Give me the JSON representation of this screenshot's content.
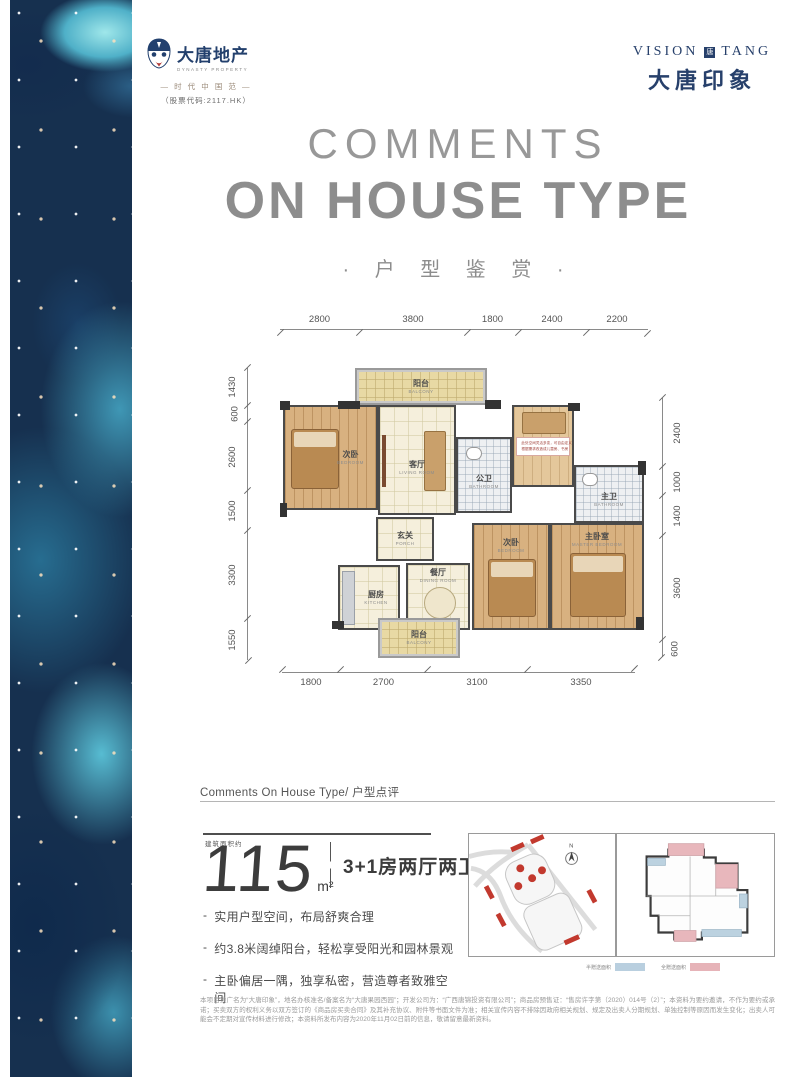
{
  "brand_left": {
    "name_cn": "大唐地产",
    "name_en": "DYNASTY PROPERTY",
    "slogan": "— 时 代 中 国 范 —",
    "stock_code": "（股票代码:2117.HK）"
  },
  "brand_right": {
    "en_left": "VISION",
    "en_right": "TANG",
    "seal_char": "唐",
    "cn": "大唐印象"
  },
  "title": {
    "en_line1": "COMMENTS",
    "en_line2": "ON HOUSE TYPE",
    "cn": "· 户 型 鉴 赏 ·"
  },
  "floorplan": {
    "dims_top": [
      "2800",
      "3800",
      "1800",
      "2400",
      "2200"
    ],
    "dims_bottom": [
      "1800",
      "2700",
      "3100",
      "3350"
    ],
    "dims_left": [
      "1430",
      "600",
      "2600",
      "1500",
      "3300",
      "1550"
    ],
    "dims_right": [
      "2400",
      "1000",
      "1400",
      "3600",
      "600"
    ],
    "rooms": {
      "balcony_top": {
        "cn": "阳台",
        "en": "BALCONY"
      },
      "bedroom_a": {
        "cn": "次卧",
        "en": "BEDROOM"
      },
      "living": {
        "cn": "客厅",
        "en": "LIVING ROOM"
      },
      "bath_public": {
        "cn": "公卫",
        "en": "BATHROOM"
      },
      "bath_master": {
        "cn": "主卫",
        "en": "BATHROOM"
      },
      "porch": {
        "cn": "玄关",
        "en": "PORCH"
      },
      "kitchen": {
        "cn": "厨房",
        "en": "KITCHEN"
      },
      "dining": {
        "cn": "餐厅",
        "en": "DINING ROOM"
      },
      "bedroom_b": {
        "cn": "次卧",
        "en": "BEDROOM"
      },
      "master": {
        "cn": "主卧室",
        "en": "MASTER BEDROOM"
      },
      "balcony_bottom": {
        "cn": "阳台",
        "en": "BALCONY"
      }
    },
    "flex_note_line1": "此处空间灵活多变，可自由定义",
    "flex_note_line2": "根据需求改造成儿童房、书房"
  },
  "comments": {
    "section_title": "Comments On House Type/ 户型点评",
    "area_label": "建筑面积约",
    "area_value": "115",
    "area_unit": "m²",
    "spec": "3+1房两厅两卫",
    "bullet_marker": "-",
    "bullets": [
      "实用户型空间，布局舒爽合理",
      "约3.8米阔绰阳台，轻松享受阳光和园林景观",
      "主卧偏居一隅，独享私密，营造尊者致雅空间"
    ]
  },
  "diagrams": {
    "compass_label": "N",
    "legend": [
      {
        "label": "半赠送面积",
        "color": "#b9cfdf"
      },
      {
        "label": "全赠送面积",
        "color": "#e6b3b8"
      }
    ]
  },
  "disclaimer": "本项目推广名为“大唐印象”，地名办核准名/备案名为“大唐果园西园”；开发公司为：“广西唐锦投资有限公司”；商品房预售证：“售房许字第（2020）014号（2）”；本资料为要约邀请，不作为要约或承诺；买卖双方的权利义务以双方签订的《商品房买卖合同》及其补充协议、附件等书面文件为准；相关宣传内容不排除因政府相关规划、规定及出卖人分期规划、单独控制等原因而发生变化；出卖人可能会不定期对宣传材料进行修改；本资料所发布内容为2020年11月02日前的信息，敬请留意最新资料。",
  "colors": {
    "brand_navy": "#27406b",
    "title_gray": "#8d8d8d",
    "text_dark": "#3c3c3c",
    "accent_red": "#c2392e"
  }
}
